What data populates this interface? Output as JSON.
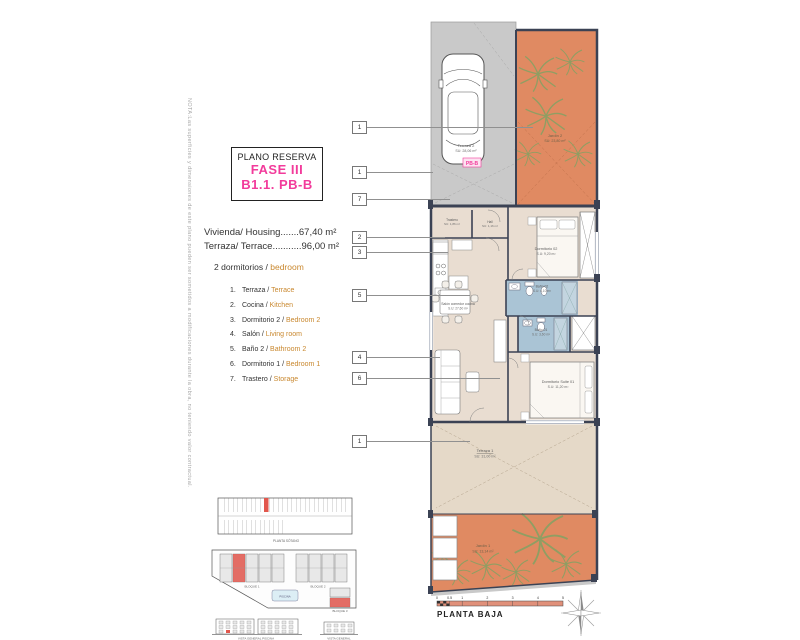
{
  "note": "NOTA:Las superficies y dimensiones de este plano pueden ser sometidos a modificaciones durante la obra, no teniendo valor contractual.",
  "title_block": {
    "line1": "PLANO RESERVA",
    "line2": "FASE III",
    "line3": "B1.1. PB-B"
  },
  "summary": {
    "housing": "Vivienda/ Housing.......67,40 m²",
    "terrace": "Terraza/ Terrace...........96,00 m²",
    "bedrooms_es": "2 dormitorios /",
    "bedrooms_en": "bedroom"
  },
  "legend": {
    "items": [
      {
        "num": "1.",
        "es": "Terraza /",
        "en": "Terrace"
      },
      {
        "num": "2.",
        "es": "Cocina /",
        "en": "Kitchen"
      },
      {
        "num": "3.",
        "es": "Dormitorio 2 /",
        "en": "Bedroom 2"
      },
      {
        "num": "4.",
        "es": "Salón /",
        "en": "Living room"
      },
      {
        "num": "5.",
        "es": "Baño 2 /",
        "en": "Bathroom 2"
      },
      {
        "num": "6.",
        "es": "Dormitorio 1 /",
        "en": "Bedroom 1"
      },
      {
        "num": "7.",
        "es": "Trastero /",
        "en": "Storage"
      }
    ]
  },
  "plan": {
    "unit_tag": "PB-B",
    "rooms": {
      "terraza2": {
        "name": "Terraza 2",
        "area": "SU: 28,06 m²"
      },
      "jardin2": {
        "name": "Jardín 2",
        "area": "SU: 23,80 m²"
      },
      "trastero": {
        "name": "Trastero",
        "area": "SU: 1,86 m²"
      },
      "hall": {
        "name": "Hall",
        "area": "SU: 1,16 m²"
      },
      "dormitorio2": {
        "name": "Dormitorio 02",
        "area": "S.U: 9,20 m²"
      },
      "bano2": {
        "name": "Baño 02",
        "area": "S.U: 4,10 m²"
      },
      "bano1": {
        "name": "Baño 01",
        "area": "S.U: 3,60 m²"
      },
      "salon": {
        "name": "Salón comedor cocina",
        "area": "S.U: 27,60 m²"
      },
      "suite": {
        "name": "Dormitorio Suite 01",
        "area": "S.U: 11,20 m²"
      },
      "terraza1": {
        "name": "Terraza 1",
        "area": "SU: 31,00 m²"
      },
      "jardin1": {
        "name": "Jardín 1",
        "area": "SU: 13,14 m²"
      }
    },
    "callouts": [
      "1",
      "1",
      "7",
      "2",
      "3",
      "5",
      "4",
      "6",
      "1"
    ]
  },
  "keyplan": {
    "parking_caption": "PLANTA SÓTANO",
    "bloque1": "BLOQUE 1",
    "bloque2": "BLOQUE 2",
    "bloque3": "BLOQUE 3",
    "piscina": "PISCINA",
    "vista_left": "VISTA GENERAL PISCINA",
    "vista_right": "VISTA GENERAL"
  },
  "footer": {
    "plan_name": "PLANTA BAJA",
    "scale_ticks": [
      "0",
      "0.5",
      "1",
      "2",
      "3",
      "4",
      "5"
    ]
  },
  "colors": {
    "accent_pink": "#f23b9b",
    "accent_orange": "#c9882f",
    "wall": "#3b4254",
    "garden": "#e08a62",
    "parking": "#c9c9c9",
    "floor": "#e9ddd1",
    "terrace": "#e5d9c8",
    "bath": "#aac4d5",
    "highlight_red": "#e2574d"
  }
}
